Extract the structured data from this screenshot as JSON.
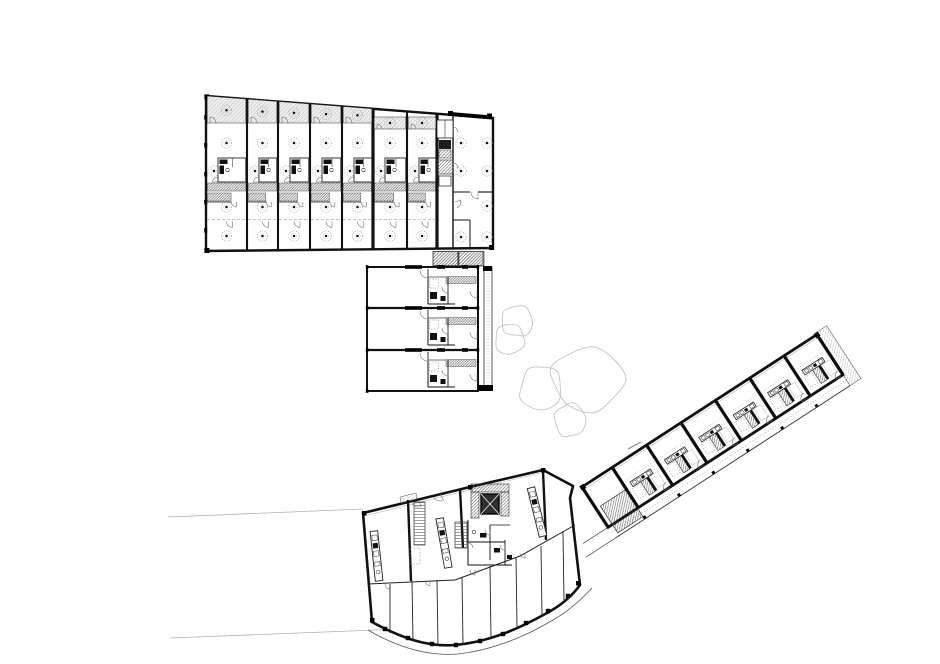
{
  "title": "site floor plan drawing",
  "colors": {
    "paper": "#ffffff",
    "ink": "#161616",
    "wall": "#111111",
    "thin": "#555555",
    "faint": "#9a9a9a",
    "tree": "#c4c4c4",
    "site_line": "#b0b0b0",
    "balcony_fill": "#ebebeb"
  },
  "site": {
    "lines": [
      [
        168,
        517,
        363,
        509
      ],
      [
        170,
        638,
        428,
        628
      ]
    ],
    "tick": [
      628,
      449,
      641,
      442
    ]
  },
  "trees": [
    {
      "cx": 517,
      "cy": 321,
      "rx": 16,
      "ry": 15,
      "rot": 0.3,
      "m": [
        1.0,
        1.12,
        0.95,
        1.08,
        0.9,
        1.05,
        0.97,
        1.1,
        0.93
      ]
    },
    {
      "cx": 510,
      "cy": 339,
      "rx": 15,
      "ry": 15,
      "rot": 1.1,
      "m": [
        0.95,
        1.05,
        1.1,
        0.92,
        1.08,
        0.96,
        1.04,
        0.9,
        1.06
      ]
    },
    {
      "cx": 587,
      "cy": 379,
      "rx": 36,
      "ry": 31,
      "rot": 0.0,
      "m": [
        1.08,
        0.95,
        1.1,
        1.0,
        0.9,
        1.07,
        0.94,
        1.05,
        0.98
      ]
    },
    {
      "cx": 541,
      "cy": 388,
      "rx": 21,
      "ry": 22,
      "rot": 2.0,
      "m": [
        1.0,
        1.1,
        0.9,
        1.06,
        0.95,
        1.08,
        0.92,
        1.03,
        1.0
      ]
    },
    {
      "cx": 570,
      "cy": 420,
      "rx": 15,
      "ry": 17,
      "rot": 0.7,
      "m": [
        1.05,
        0.92,
        1.08,
        0.96,
        1.1,
        0.9,
        1.04,
        0.97,
        1.06
      ]
    }
  ],
  "building_a": {
    "x0": 206,
    "x1": 493,
    "y_tl": 96,
    "y_tr": 118,
    "y_bl": 251,
    "y_br": 248,
    "bay_lefts": [
      206,
      247,
      278,
      310,
      342,
      373,
      407
    ],
    "bay_rights": [
      247,
      278,
      310,
      342,
      373,
      407,
      437
    ],
    "thick_walls": [
      373,
      437
    ],
    "balcony_bottom": 123,
    "inset_bays": [
      5,
      6
    ],
    "inset_strip": [
      117,
      129
    ],
    "core_top": 158,
    "core_bottom": 182,
    "band1": [
      183,
      191
    ],
    "band2": [
      193,
      201
    ],
    "wall_y": 201.5,
    "dash_y": 219.5,
    "light_rows": {
      "living": 143,
      "core": 171,
      "mid": 207,
      "bottom": 236
    },
    "left_edge_ticks": [
      115,
      143,
      172,
      200,
      228
    ],
    "right_unit": {
      "x0": 453,
      "x1": 493,
      "strip_x": 437,
      "lights": [
        [
          461,
          143
        ],
        [
          487,
          143
        ],
        [
          461,
          171
        ],
        [
          487,
          171
        ],
        [
          487,
          206
        ],
        [
          461,
          237
        ],
        [
          487,
          237
        ]
      ],
      "top_wall": [
        450,
        114,
        492,
        117.5
      ]
    },
    "entry_hatch": [
      [
        433,
        251.5,
        25,
        14
      ],
      [
        459,
        251.5,
        24,
        14
      ]
    ]
  },
  "building_b": {
    "x0": 367,
    "x1": 478,
    "y0": 267,
    "y1": 391,
    "unit_tops": [
      267,
      308,
      350
    ],
    "gallery": {
      "x0": 484,
      "x1": 492,
      "y0": 267,
      "y1": 389,
      "top_block": [
        483,
        266,
        9,
        5
      ],
      "bottom_block": [
        479,
        385,
        14,
        6
      ]
    },
    "kitchen_band": [
      446,
      9.5,
      30,
      7
    ],
    "top_blocks": [
      [
        405,
        17
      ],
      [
        437,
        8
      ],
      [
        462,
        6
      ]
    ]
  },
  "building_c": {
    "origin": [
      582,
      487
    ],
    "angle": -33,
    "length": 280,
    "depth": 48,
    "gallery_depth": 13,
    "stair_zone": [
      5,
      26,
      30,
      32
    ],
    "party_walls": [
      36,
      77,
      118,
      159,
      200,
      241
    ],
    "bay_width": 41,
    "end_wrap": 13,
    "gallery_ext": 30
  },
  "building_d": {
    "outline": "M363,513 L470,487 L543,470 L573,486 L570,498 L580,585 C572,596 560,606 547,613 C520,628 490,642 455,645 C430,647 405,640 372,622 Z",
    "inner_top_line": "M366,515.5 L470,489.8 L541,473",
    "outer_curve": "M368,630 C402,650 432,656 458,654 C494,650 526,636 553,620 C567,612 581,600 592,588",
    "party_walls": [
      [
        408,
        500,
        411,
        581
      ],
      [
        460,
        489,
        463,
        548
      ],
      [
        543,
        471,
        546,
        540
      ]
    ],
    "corridor": [
      [
        368,
        584
      ],
      [
        455,
        580
      ],
      [
        520,
        556
      ],
      [
        575,
        525
      ]
    ],
    "room_walls": [
      [
        390,
        584,
        390,
        633
      ],
      [
        412,
        581,
        413,
        641
      ],
      [
        437,
        580,
        438,
        645
      ],
      [
        462,
        577,
        463,
        645
      ],
      [
        490,
        566,
        491,
        639
      ],
      [
        516,
        557,
        517,
        628
      ],
      [
        541,
        546,
        542,
        615
      ],
      [
        563,
        532,
        564,
        600
      ]
    ],
    "columns": [
      [
        385,
        629
      ],
      [
        408,
        638
      ],
      [
        432,
        644
      ],
      [
        456,
        645
      ],
      [
        480,
        641
      ],
      [
        503,
        634
      ],
      [
        526,
        623
      ],
      [
        548,
        611
      ],
      [
        568,
        596
      ]
    ],
    "islands": [
      {
        "cx": 376.5,
        "cy": 556,
        "angle": -6
      },
      {
        "cx": 444,
        "cy": 543,
        "angle": -10
      },
      {
        "cx": 537,
        "cy": 512,
        "angle": -14
      }
    ],
    "stairs": [
      [
        414,
        502,
        11,
        43
      ],
      [
        455,
        522,
        12,
        26
      ]
    ],
    "void_dash": [
      410,
      548,
      10,
      16
    ],
    "elevator": {
      "x": 481,
      "y": 494,
      "w": 18,
      "h": 20
    },
    "entry_notch": [
      [
        400,
        497
      ],
      [
        416,
        493
      ],
      [
        417,
        499
      ],
      [
        401,
        503
      ]
    ],
    "corner_ticks": [
      [
        362,
        511
      ],
      [
        370,
        618
      ],
      [
        468,
        485
      ],
      [
        541,
        468
      ],
      [
        576,
        581
      ]
    ]
  },
  "connector_ab": [
    [
      433,
      251.5,
      25,
      14.5
    ],
    [
      458,
      251.5,
      26,
      14.5
    ]
  ]
}
